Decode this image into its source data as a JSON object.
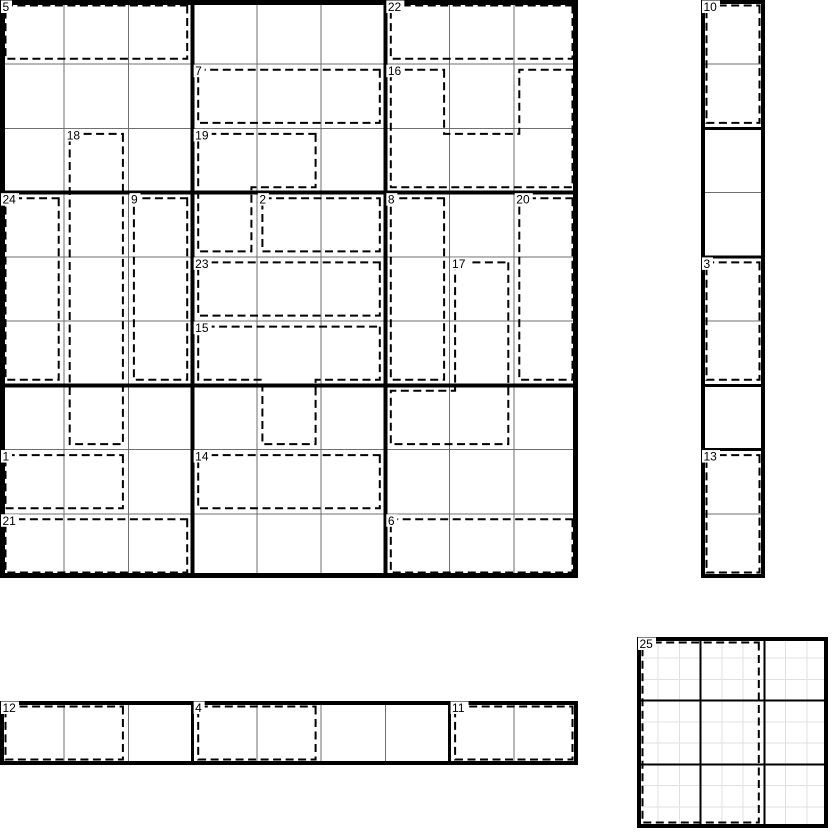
{
  "puzzle": {
    "title": "killer-cage puzzle sheet",
    "colors": {
      "background": "#ffffff",
      "cell_line": "#6f6f6f",
      "box_line": "#000000",
      "cage_line": "#000000",
      "minor_line": "#e0e0e0",
      "label_text": "#000000"
    },
    "cage_style": {
      "inset": 5.5,
      "stroke_width": 2,
      "dash": "8 4.5"
    },
    "grids": [
      {
        "name": "main-grid",
        "x": 0,
        "y": 0,
        "width": 578,
        "height": 578,
        "rows": 9,
        "cols": 9,
        "click_rows": 9,
        "click_cols": 9,
        "thick_v": [
          3,
          6
        ],
        "thick_h": [
          3,
          6
        ],
        "box_width": 4,
        "border_width": 5,
        "line_color": "#6f6f6f",
        "box_color": "#000000",
        "cages": [
          {
            "label": "5",
            "rect": [
              0,
              0,
              0,
              2
            ]
          },
          {
            "label": "22",
            "rect": [
              0,
              6,
              0,
              8
            ]
          },
          {
            "label": "7",
            "rect": [
              1,
              3,
              1,
              5
            ]
          },
          {
            "label": "16",
            "cells": [
              [
                1,
                6
              ],
              [
                1,
                8
              ],
              [
                2,
                6
              ],
              [
                2,
                7
              ],
              [
                2,
                8
              ]
            ]
          },
          {
            "label": "18",
            "rect": [
              2,
              1,
              6,
              1
            ]
          },
          {
            "label": "19",
            "cells": [
              [
                2,
                3
              ],
              [
                2,
                4
              ],
              [
                3,
                3
              ]
            ]
          },
          {
            "label": "24",
            "rect": [
              3,
              0,
              5,
              0
            ]
          },
          {
            "label": "9",
            "rect": [
              3,
              2,
              5,
              2
            ]
          },
          {
            "label": "2",
            "rect": [
              3,
              4,
              3,
              5
            ]
          },
          {
            "label": "8",
            "rect": [
              3,
              6,
              5,
              6
            ]
          },
          {
            "label": "20",
            "rect": [
              3,
              8,
              5,
              8
            ]
          },
          {
            "label": "23",
            "rect": [
              4,
              3,
              4,
              5
            ]
          },
          {
            "label": "17",
            "cells": [
              [
                4,
                7
              ],
              [
                5,
                7
              ],
              [
                6,
                6
              ],
              [
                6,
                7
              ]
            ]
          },
          {
            "label": "15",
            "cells": [
              [
                5,
                3
              ],
              [
                5,
                4
              ],
              [
                5,
                5
              ],
              [
                6,
                4
              ]
            ]
          },
          {
            "label": "1",
            "rect": [
              7,
              0,
              7,
              1
            ]
          },
          {
            "label": "14",
            "rect": [
              7,
              3,
              7,
              5
            ]
          },
          {
            "label": "21",
            "rect": [
              8,
              0,
              8,
              2
            ]
          },
          {
            "label": "6",
            "rect": [
              8,
              6,
              8,
              8
            ]
          }
        ]
      },
      {
        "name": "column-strip",
        "x": 701,
        "y": 0,
        "width": 64,
        "height": 578,
        "rows": 9,
        "cols": 1,
        "click_rows": 9,
        "click_cols": 1,
        "thick_v": [],
        "thick_h": [
          2,
          4,
          6,
          7
        ],
        "box_width": 3,
        "border_width": 4,
        "line_color": "#6f6f6f",
        "box_color": "#000000",
        "cages": [
          {
            "label": "10",
            "rect": [
              0,
              0,
              1,
              0
            ]
          },
          {
            "label": "3",
            "rect": [
              4,
              0,
              5,
              0
            ]
          },
          {
            "label": "13",
            "rect": [
              7,
              0,
              8,
              0
            ]
          }
        ]
      },
      {
        "name": "row-strip",
        "x": 0,
        "y": 701,
        "width": 578,
        "height": 64,
        "rows": 1,
        "cols": 9,
        "click_rows": 1,
        "click_cols": 9,
        "thick_v": [
          3,
          7
        ],
        "thick_h": [],
        "box_width": 3,
        "border_width": 4,
        "line_color": "#6f6f6f",
        "box_color": "#000000",
        "cages": [
          {
            "label": "12",
            "rect": [
              0,
              0,
              0,
              1
            ]
          },
          {
            "label": "4",
            "rect": [
              0,
              3,
              0,
              4
            ]
          },
          {
            "label": "11",
            "rect": [
              0,
              7,
              0,
              8
            ]
          }
        ]
      },
      {
        "name": "mini-grid",
        "x": 637,
        "y": 637,
        "width": 191,
        "height": 191,
        "rows": 9,
        "cols": 9,
        "click_rows": 3,
        "click_cols": 3,
        "thick_v": [
          3,
          6
        ],
        "thick_h": [
          3,
          6
        ],
        "box_width": 2,
        "border_width": 4,
        "line_color": "#e0e0e0",
        "box_color": "#000000",
        "cages": [
          {
            "label": "25",
            "rect": [
              0,
              0,
              8,
              5
            ]
          }
        ]
      }
    ]
  }
}
